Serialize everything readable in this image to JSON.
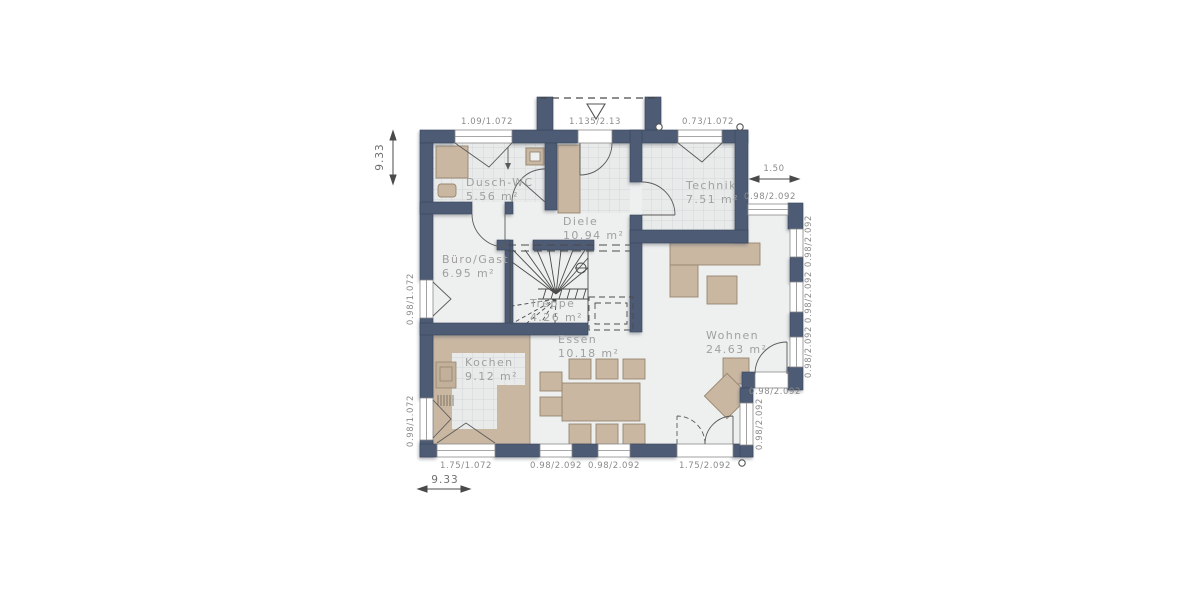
{
  "plan": {
    "type": "floor-plan",
    "rooms": [
      {
        "name": "Dusch-WC",
        "area": "5.56 m²"
      },
      {
        "name": "Technik",
        "area": "7.51 m²"
      },
      {
        "name": "Diele",
        "area": "10.94 m²"
      },
      {
        "name": "Büro/Gast",
        "area": "6.95 m²"
      },
      {
        "name": "Treppe",
        "area": "4.26 m²"
      },
      {
        "name": "Kochen",
        "area": "9.12 m²"
      },
      {
        "name": "Essen",
        "area": "10.18 m²"
      },
      {
        "name": "Wohnen",
        "area": "24.63 m²"
      }
    ],
    "dimensions": {
      "total_depth": "9.33",
      "total_width": "9.33",
      "bay_projection": "1.50",
      "top": [
        "1.09/1.072",
        "1.135/2.13",
        "0.73/1.072"
      ],
      "bottom": [
        "1.75/1.072",
        "0.98/2.092",
        "0.98/2.092",
        "1.75/2.092"
      ],
      "left": [
        "0.98/1.072",
        "0.98/1.072"
      ],
      "right": [
        "0.98/2.092",
        "0.98/2.092",
        "0.98/2.092",
        "0.98/2.092",
        "0.98/2.092",
        "0.98/2.092"
      ]
    },
    "colors": {
      "wall": "#4d5b75",
      "floor": "#eef0f0",
      "tile": "#e9ebeb",
      "furniture": "#c9b7a2",
      "room_text": "#9f9f9f",
      "dim_text": "#8b8b8b"
    }
  }
}
